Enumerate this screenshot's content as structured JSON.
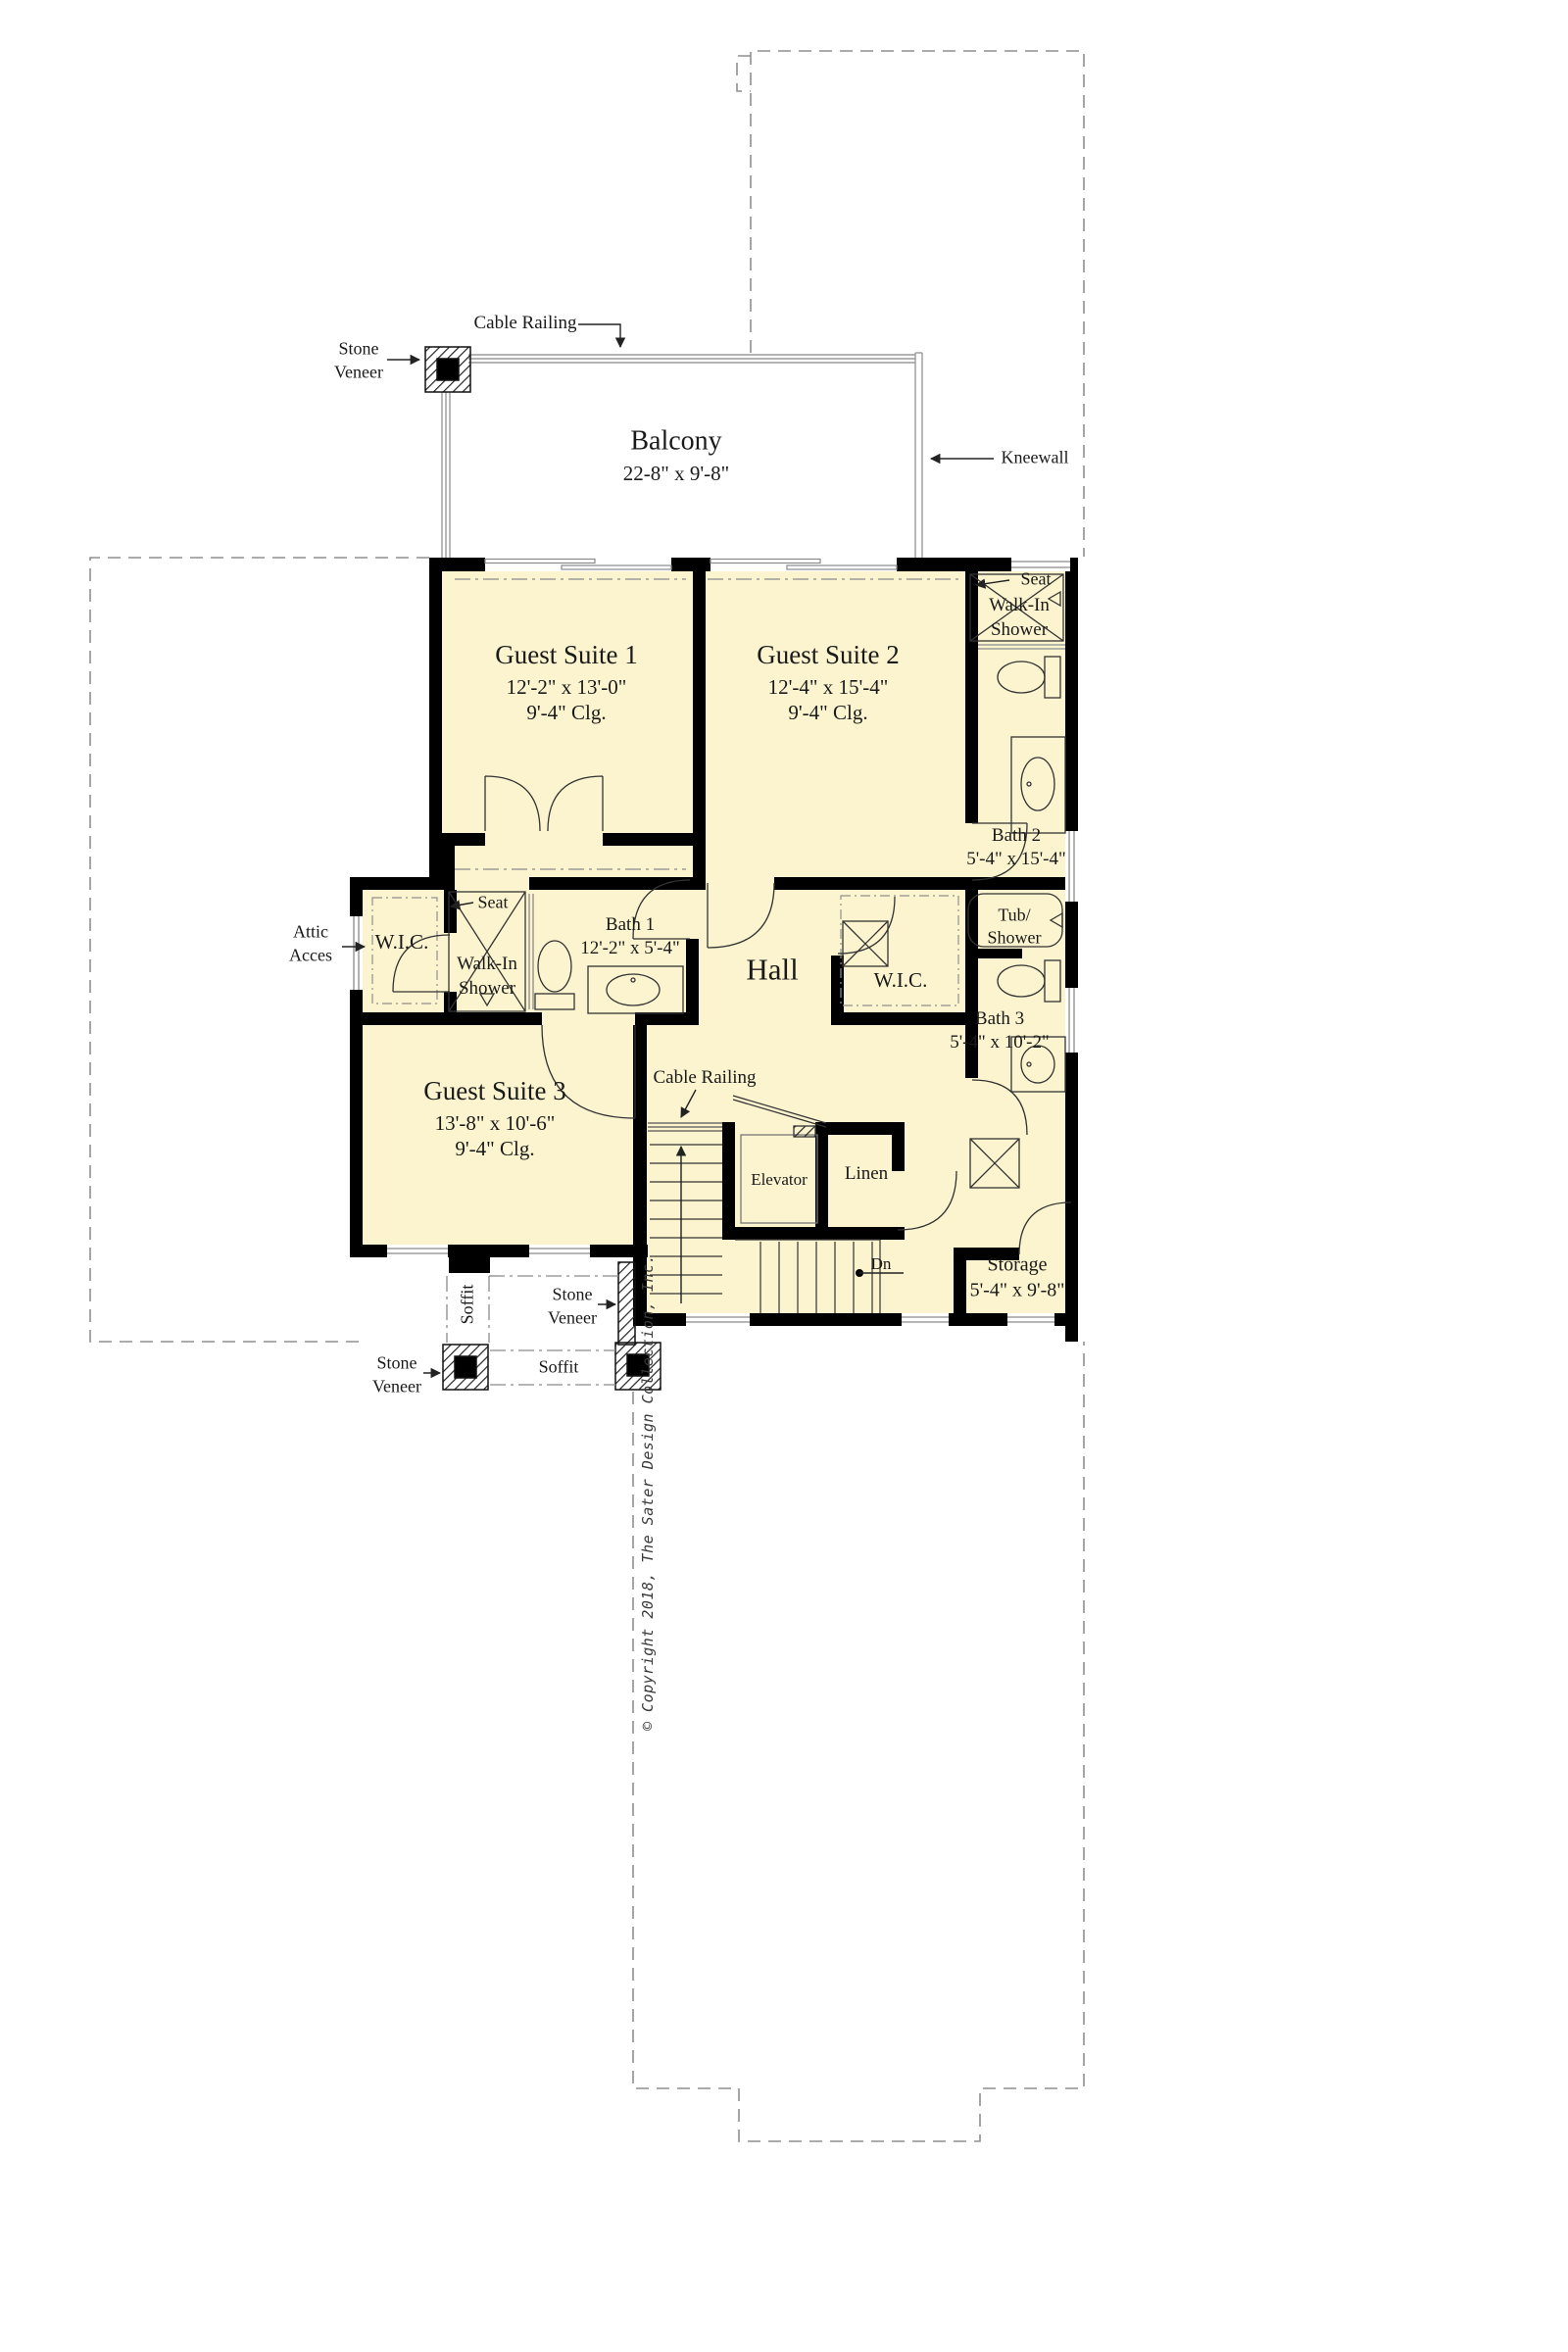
{
  "meta": {
    "drawing_type": "second floor plan"
  },
  "colors": {
    "room_fill": "#FBF4CF",
    "wall": "#000000",
    "thin_line": "#8a8a8a",
    "text": "#1a1a1a"
  },
  "balcony": {
    "name": "Balcony",
    "dims": "22-8\" x 9'-8\""
  },
  "rooms": {
    "guest1": {
      "name": "Guest Suite 1",
      "dims": "12'-2\" x 13'-0\"",
      "clg": "9'-4\" Clg."
    },
    "guest2": {
      "name": "Guest Suite 2",
      "dims": "12'-4\" x 15'-4\"",
      "clg": "9'-4\" Clg."
    },
    "guest3": {
      "name": "Guest Suite 3",
      "dims": "13'-8\" x 10'-6\"",
      "clg": "9'-4\" Clg."
    },
    "bath1": {
      "name": "Bath 1",
      "dims": "12'-2\" x 5'-4\""
    },
    "bath2": {
      "name": "Bath 2",
      "dims": "5'-4\" x 15'-4\""
    },
    "bath3": {
      "name": "Bath 3",
      "dims": "5'-4\" x 10'-2\""
    },
    "storage": {
      "name": "Storage",
      "dims": "5'-4\" x 9'-8\""
    },
    "hall": {
      "name": "Hall"
    },
    "wic": {
      "name": "W.I.C."
    },
    "linen": {
      "name": "Linen"
    },
    "elevator": {
      "name": "Elevator"
    },
    "tub_shower": {
      "l1": "Tub/",
      "l2": "Shower"
    },
    "walkin_shower": {
      "l1": "Walk-In",
      "l2": "Shower"
    }
  },
  "annotations": {
    "cable_railing": "Cable Railing",
    "stone": {
      "l1": "Stone",
      "l2": "Veneer"
    },
    "kneewall": "Kneewall",
    "seat": "Seat",
    "attic": {
      "l1": "Attic",
      "l2": "Acces"
    },
    "soffit": "Soffit",
    "dn": "Dn",
    "copyright": "© Copyright 2018, The Sater Design Collection, Inc."
  }
}
